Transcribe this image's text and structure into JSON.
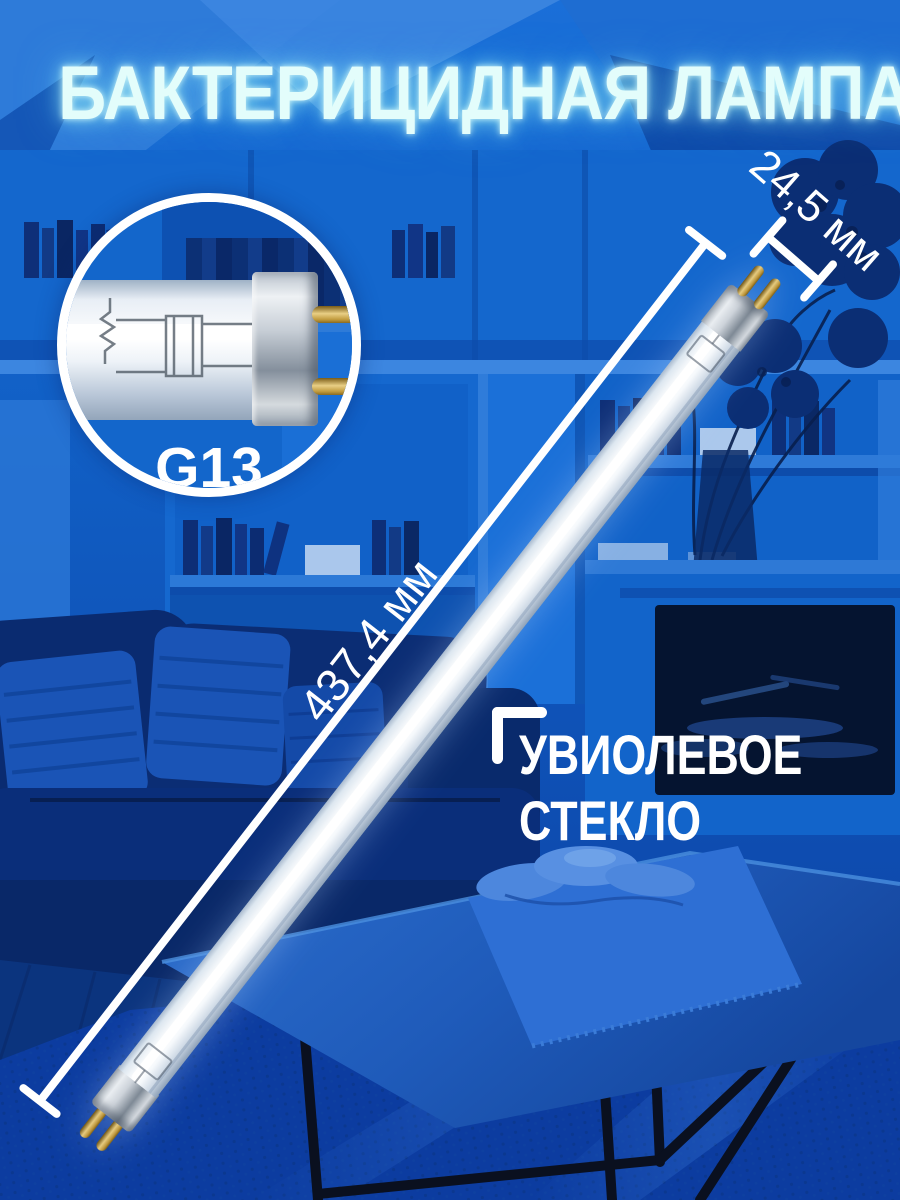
{
  "title": {
    "text": "БАКТЕРИЦИДНАЯ ЛАМПА"
  },
  "inset": {
    "base_label": "G13"
  },
  "annotations": {
    "diameter_label": "24,5 мм",
    "length_label": "437,4 мм",
    "glass_line1": "УВИОЛЕВОЕ",
    "glass_line2": "СТЕКЛО"
  },
  "colors": {
    "scene_blue": "#1160c6",
    "deep_blue": "#0a2b70",
    "title_glow_cyan": "#d9fbf9",
    "annotation_white": "#ffffff",
    "pin_gold": "#d9b968"
  }
}
